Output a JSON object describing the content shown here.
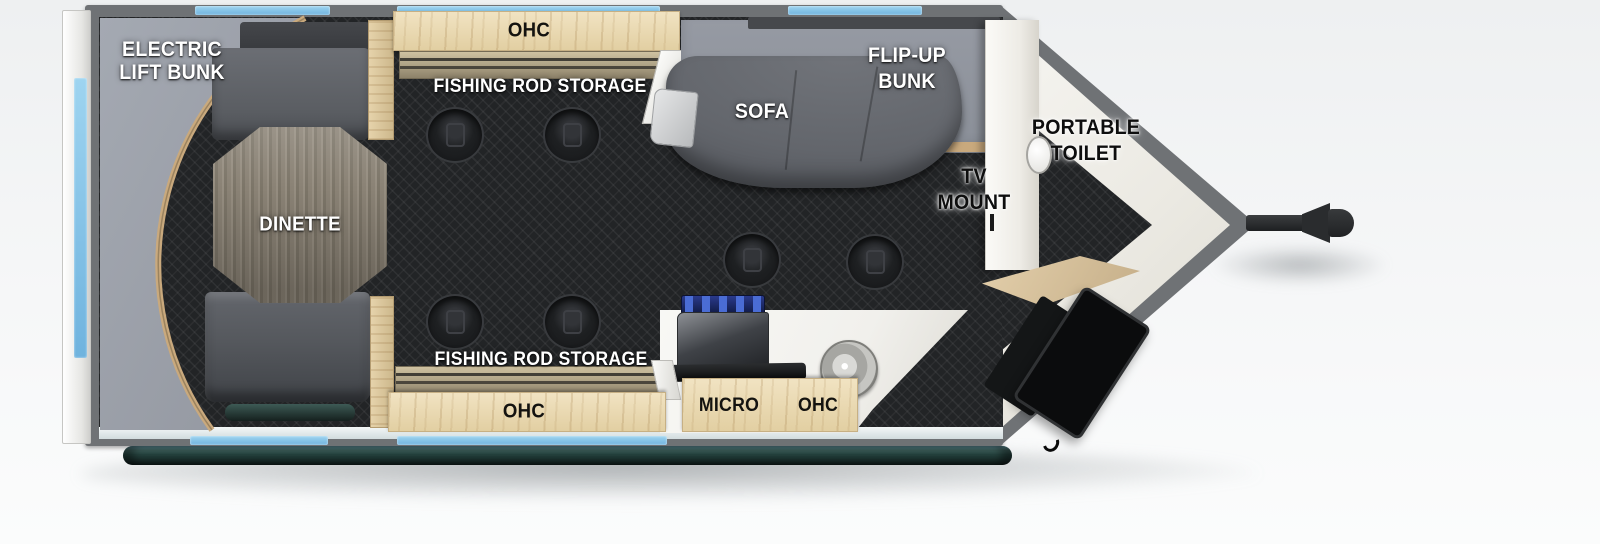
{
  "title": "Travel trailer floor plan",
  "areas": {
    "electric_lift_bunk": {
      "line1": "ELECTRIC",
      "line2": "LIFT BUNK"
    },
    "dinette": {
      "label": "DINETTE"
    },
    "top_cabinet": {
      "label": "OHC"
    },
    "top_rod_storage": {
      "label": "FISHING ROD STORAGE"
    },
    "sofa": {
      "label": "SOFA"
    },
    "flip_up_bunk": {
      "line1": "FLIP-UP",
      "line2": "BUNK"
    },
    "tv_mount": {
      "line1": "TV",
      "line2": "MOUNT"
    },
    "portable_toilet": {
      "line1": "PORTABLE",
      "line2": "TOILET"
    },
    "bottom_rod_storage": {
      "label": "FISHING ROD STORAGE"
    },
    "bottom_cabinet": {
      "label": "OHC"
    },
    "kitchen": {
      "micro_label": "MICRO",
      "ohc_label": "OHC"
    }
  },
  "colors": {
    "window_blue": "#84c4ea",
    "wall_gray": "#6f7275",
    "floor_dark": "#222426",
    "wood_light": "#ead9b5",
    "wood_trim": "#c9a97d",
    "bunk_gray": "#9ba0a9",
    "sofa_gray": "#64676d",
    "rail_teal": "#2a4440",
    "counter_white": "#f5f5f2",
    "burner_blue": "#25348a"
  }
}
